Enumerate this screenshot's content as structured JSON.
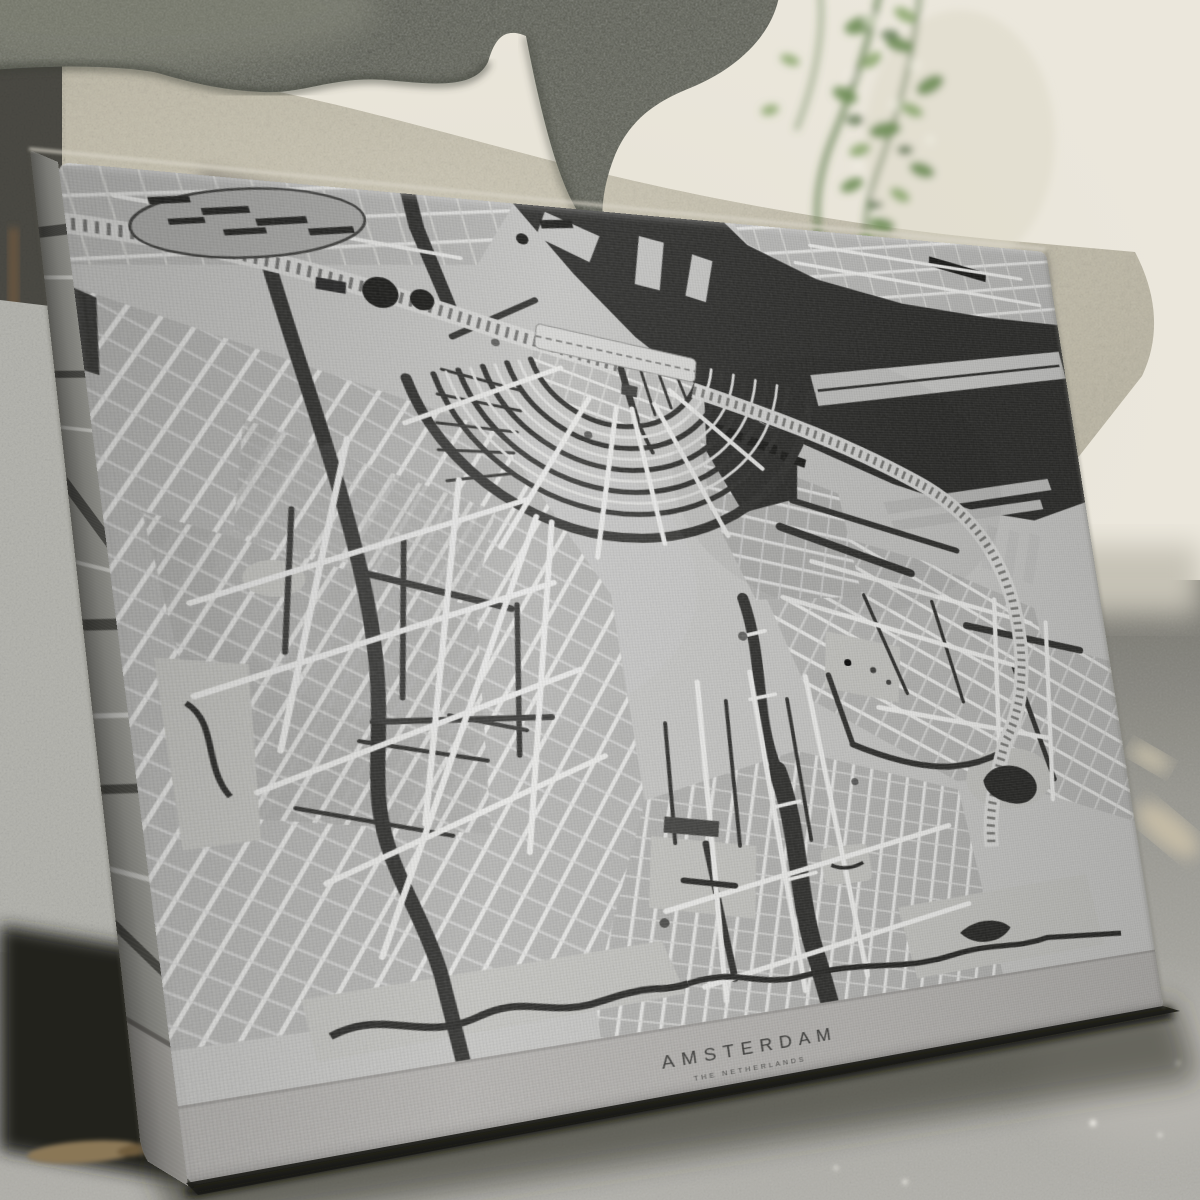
{
  "print": {
    "title": "AMSTERDAM",
    "subtitle": "THE NETHERLANDS"
  },
  "artwork": {
    "city": "Amsterdam",
    "country": "The Netherlands",
    "style": "grayscale vintage street map on stretched canvas",
    "colors": {
      "map_background": "#c6c6c4",
      "water": "#262624",
      "streets": "#ededeb",
      "blocks": "#b3b3b1",
      "title_band": "#b2b0ad",
      "title_text": "#3b3b39"
    }
  },
  "scene": {
    "elements": [
      "stone planter",
      "concrete pedestal",
      "cream wall",
      "hanging green plant",
      "concrete floor",
      "leaning canvas print"
    ],
    "colors": {
      "wall": "#ebe7dc",
      "planter_stone": "#5e6056",
      "pedestal": "#c0bbaa",
      "floor": "#a5a49e",
      "plant_green": "#5e7c4a"
    }
  }
}
